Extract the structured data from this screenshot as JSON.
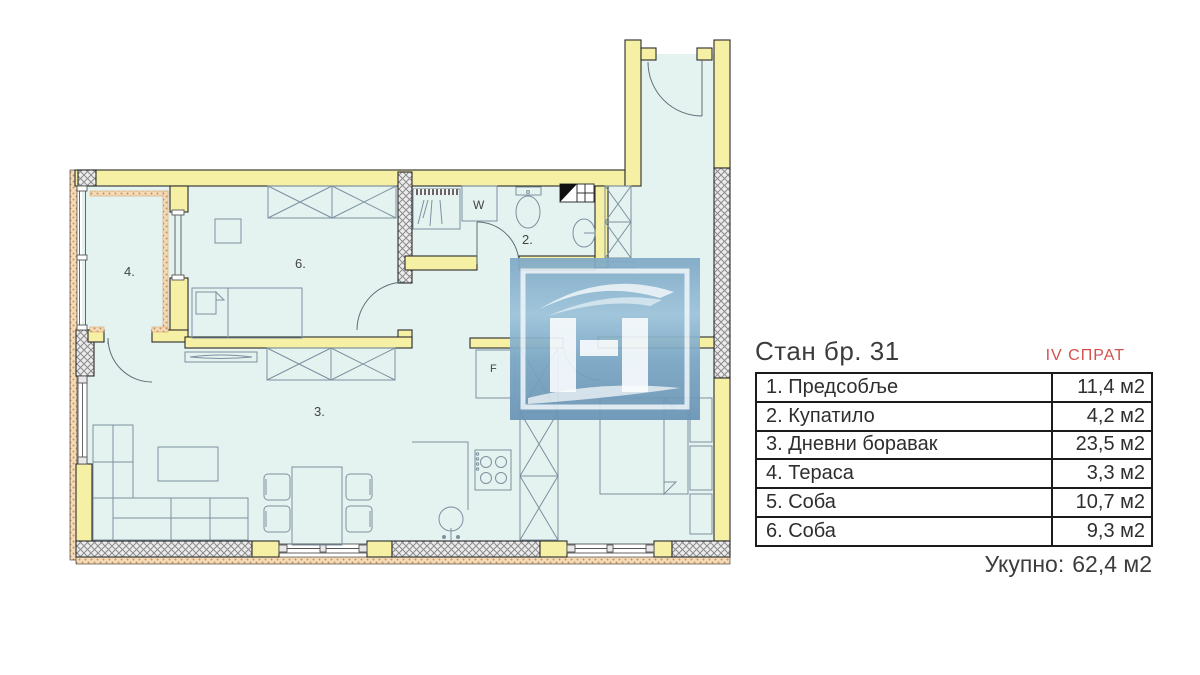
{
  "panel": {
    "title": "Стан бр. 31",
    "floor_label": "IV СПРАТ",
    "rows": [
      {
        "name": "1. Предсобље",
        "area": "11,4 м2"
      },
      {
        "name": "2. Купатило",
        "area": "4,2 м2"
      },
      {
        "name": "3. Дневни боравак",
        "area": "23,5 м2"
      },
      {
        "name": "4. Тераса",
        "area": "3,3 м2"
      },
      {
        "name": "5. Соба",
        "area": "10,7 м2"
      },
      {
        "name": "6. Соба",
        "area": "9,3 м2"
      }
    ],
    "total_label": "Укупно:",
    "total_value": "62,4 м2"
  },
  "plan": {
    "labels": {
      "terrace": "4.",
      "room6": "6.",
      "bathroom": "2.",
      "living": "3.",
      "washer": "W",
      "fridge": "F"
    }
  },
  "colors": {
    "wall_yellow": "#f6f0a5",
    "floor_cyan": "#e4f3f0",
    "insulation_orange": "#ecc18d",
    "accent_red": "#d4504e",
    "watermark_blue": "#7ba6c4",
    "line_dark": "#2b2b2b"
  }
}
